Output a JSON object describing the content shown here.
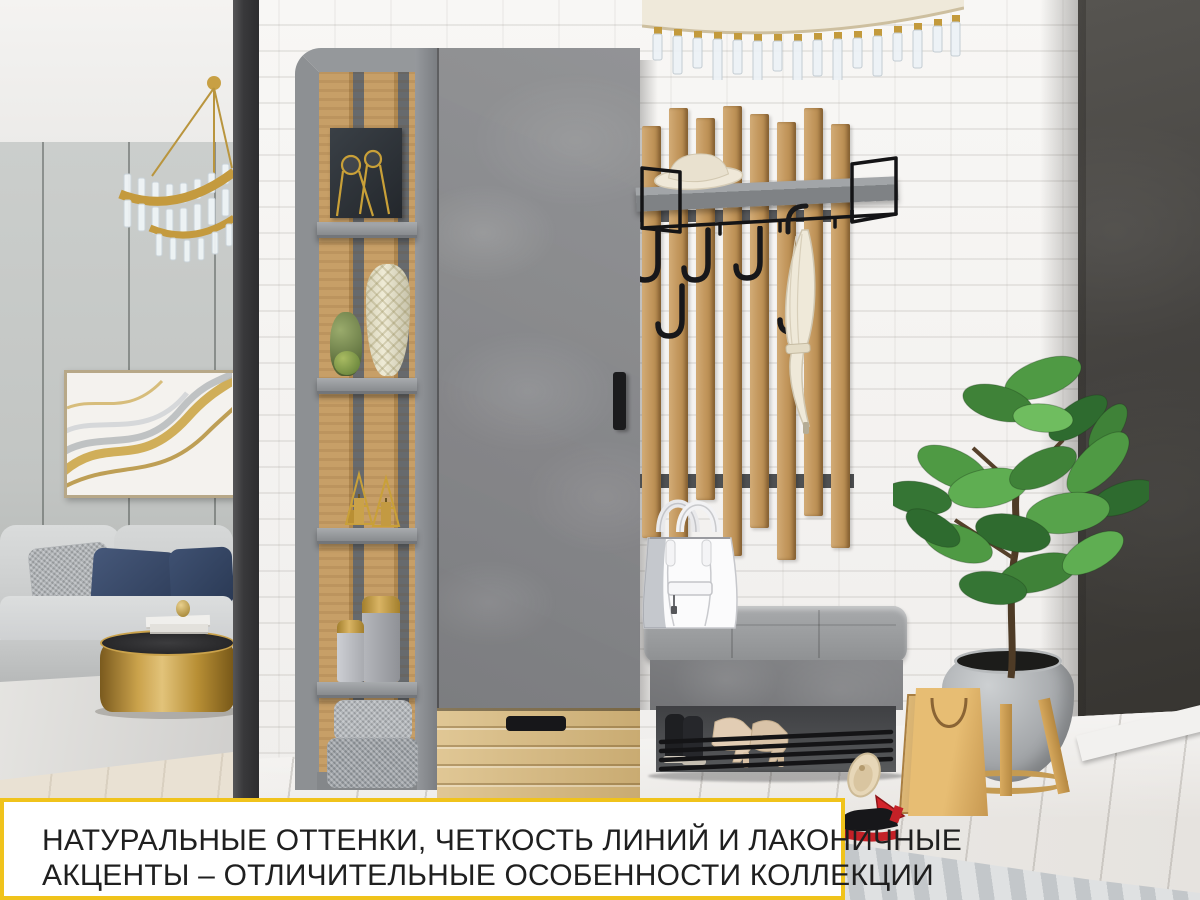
{
  "banner": {
    "line1": "НАТУРАЛЬНЫЕ ОТТЕНКИ, ЧЕТКОСТЬ ЛИНИЙ И ЛАКОНИЧНЫЕ",
    "line2": "АКЦЕНТЫ – ОТЛИЧИТЕЛЬНЫЕ ОСОБЕННОСТИ КОЛЛЕКЦИИ"
  },
  "palette": {
    "accent_yellow": "#F0C31B",
    "banner_background": "#FFFFFF",
    "banner_text": "#1F1F1F",
    "oak_wood": "#C7A06A",
    "light_oak_drawer": "#D8BD8C",
    "furniture_concrete_gray": "#8A8B8E",
    "frame_gray": "#8D9093",
    "dark_accent_wall": "#44423F",
    "white_brick": "#F5F4F2",
    "metal_black": "#1B1B1D",
    "plant_green": "#4C8F46",
    "gold_decor": "#C9A038",
    "navy_pillow": "#3A4A63",
    "red_sole": "#C42127"
  }
}
